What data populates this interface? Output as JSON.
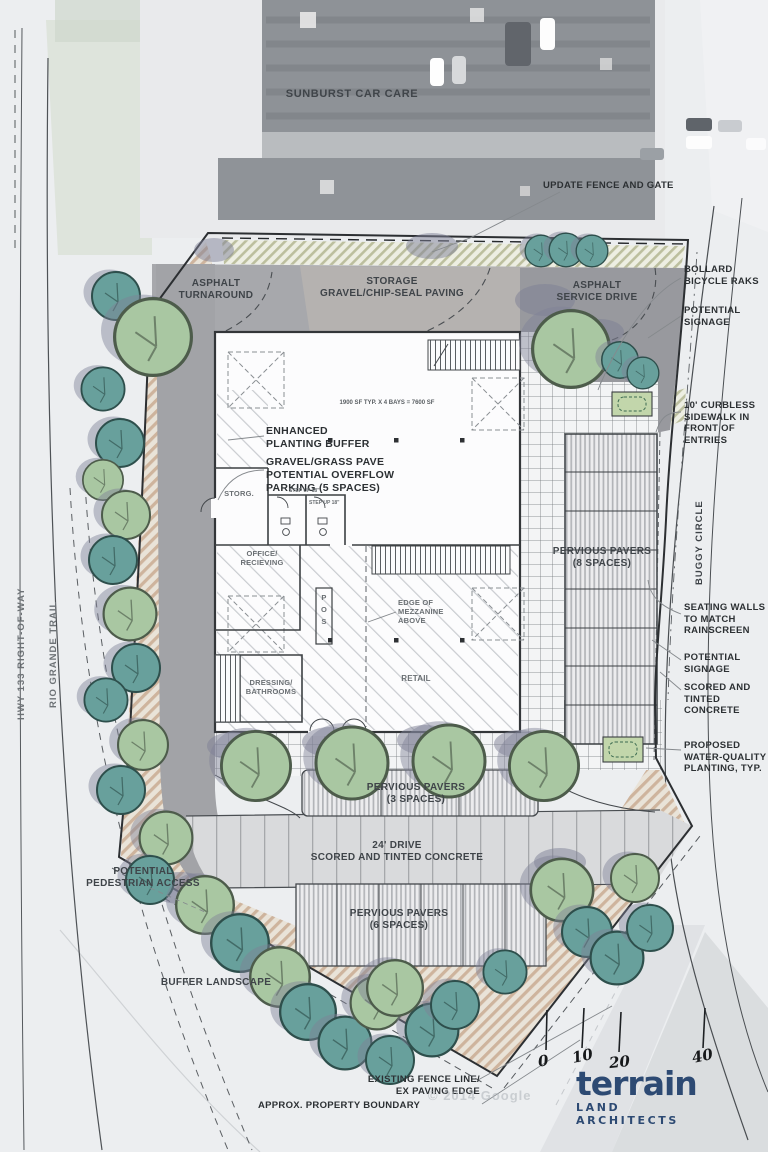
{
  "context": {
    "business_label": "SUNBURST CAR CARE",
    "google_credit": "© 2014 Google"
  },
  "roads": {
    "hwy133": "HWY 133 RIGHT-OF-WAY",
    "rio_grande": "RIO GRANDE TRAIL",
    "buggy_circle": "BUGGY CIRCLE"
  },
  "site_labels": {
    "asphalt_turnaround": "ASPHALT\nTURNAROUND",
    "storage_paving": "STORAGE\nGRAVEL/CHIP-SEAL PAVING",
    "asphalt_service_drive": "ASPHALT\nSERVICE DRIVE",
    "pervious_pavers_8": "PERVIOUS PAVERS\n(8 SPACES)",
    "pervious_pavers_3": "PERVIOUS PAVERS\n(3 SPACES)",
    "drive_24": "24' DRIVE\nSCORED AND TINTED CONCRETE",
    "pervious_pavers_6": "PERVIOUS PAVERS\n(6 SPACES)",
    "buffer_landscape": "BUFFER LANDSCAPE",
    "potential_pedestrian_access": "POTENTIAL\nPEDESTRIAN ACCESS"
  },
  "building": {
    "area_note": "1900 SF TYP. X 4 BAYS = 7600 SF",
    "storage_room": "STORG.",
    "office": "OFFICE/\nRECIEVING",
    "dressing": "DRESSING/\nBATHROOMS",
    "retail": "RETAIL",
    "pos": "P\nO\nS",
    "mezzanine": "EDGE OF\nMEZZANINE\nABOVE",
    "step_up_left": "STEP UP 18\"",
    "step_up_right": "STEP UP 18\""
  },
  "callouts": {
    "update_fence": "UPDATE FENCE AND GATE",
    "bollard_racks": "BOLLARD\nBICYCLE RAKS",
    "potential_signage_upper": "POTENTIAL\nSIGNAGE",
    "curbless_sidewalk": "10' CURBLESS\nSIDEWALK IN\nFRONT OF\nENTRIES",
    "enhanced_buffer": "ENHANCED\nPLANTING BUFFER",
    "gravel_grass_pave": "GRAVEL/GRASS PAVE\nPOTENTIAL OVERFLOW\nPARKING (5 SPACES)",
    "seating_walls": "SEATING WALLS\nTO MATCH\nRAINSCREEN",
    "potential_signage_lower": "POTENTIAL\nSIGNAGE",
    "scored_tinted": "SCORED AND\nTINTED CONCRETE",
    "water_quality": "PROPOSED\nWATER-QUALITY\nPLANTING, TYP.",
    "existing_fence": "EXISTING FENCE LINE/\nEX PAVING EDGE",
    "property_boundary": "APPROX. PROPERTY BOUNDARY"
  },
  "scale_bar": {
    "ticks": [
      "0",
      "10",
      "20",
      "40"
    ]
  },
  "logo": {
    "name": "terrain",
    "tagline": "LAND ARCHITECTS"
  },
  "colors": {
    "tree_green": "#a9c7a2",
    "tree_teal": "#68a09c",
    "asphalt": "#a7a8ac",
    "buffer_tan": "#c7a98f",
    "logo_navy": "#2d4a73",
    "label_ink": "#3f4449"
  }
}
